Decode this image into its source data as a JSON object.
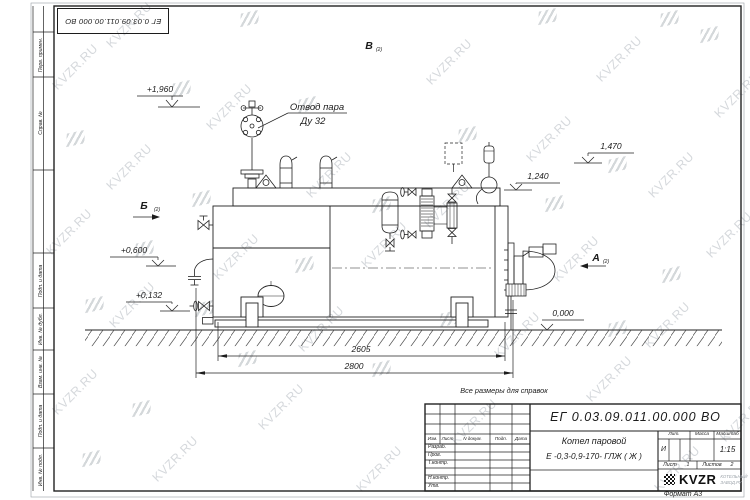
{
  "sheet": {
    "bg": "#ffffff",
    "line_color": "#222222",
    "watermark_color": "#b4bac0"
  },
  "watermark": {
    "text": "KVZR.RU"
  },
  "top_stamp": {
    "doc_number": "ЕГ 0.03.09.011.00.000  ВО"
  },
  "side_strip": {
    "top_labels": [
      "Перв. примен.",
      "Справ. №"
    ],
    "bottom_labels": [
      "Подп. и дата",
      "Инв. № дубл.",
      "Взам. инв. №",
      "Подп. и дата",
      "Инв. № подл."
    ]
  },
  "annotations": {
    "steam_outlet": {
      "line1": "Отвод пара",
      "line2": "Ду 32"
    },
    "elevations": {
      "e1960": "+1,960",
      "e0600": "+0,600",
      "e0132": "+0,132",
      "e1470": "1,470",
      "e1240": "1,240",
      "e0000": "0,000"
    },
    "views": {
      "a": "А",
      "b": "Б",
      "v": "В",
      "sheet_ref": "(2)"
    },
    "dimensions": {
      "d2605": "2605",
      "d2800": "2800"
    },
    "note": "Все размеры для справок"
  },
  "title_block": {
    "doc_number": "ЕГ 0.03.09.011.00.000  ВО",
    "product": {
      "line1": "Котел паровой",
      "line2": "Е -0,3-0,9-170- ГЛЖ ( Ж )"
    },
    "columns": {
      "izm": "Изм.",
      "list": "Лист",
      "ndoc": "N докум.",
      "podp": "Подп.",
      "data": "Дата"
    },
    "rows": {
      "razrab": "Разраб.",
      "prov": "Пров.",
      "tkontr": "Т.контр.",
      "nkontr": "Н.контр.",
      "utv": "Утв."
    },
    "lit": {
      "label": "Лит.",
      "value": "И"
    },
    "mass": {
      "label": "Масса",
      "value": ""
    },
    "scale": {
      "label": "Масштаб",
      "value": "1:15"
    },
    "sheet": {
      "label": "Лист",
      "value": "1"
    },
    "sheets": {
      "label": "Листов",
      "value": "2"
    },
    "logo": {
      "name": "KVZR",
      "sub1": "КОТЕЛЬНЫЙ",
      "sub2": "ЗАВОД.РУ"
    },
    "format": "Формат А3"
  }
}
